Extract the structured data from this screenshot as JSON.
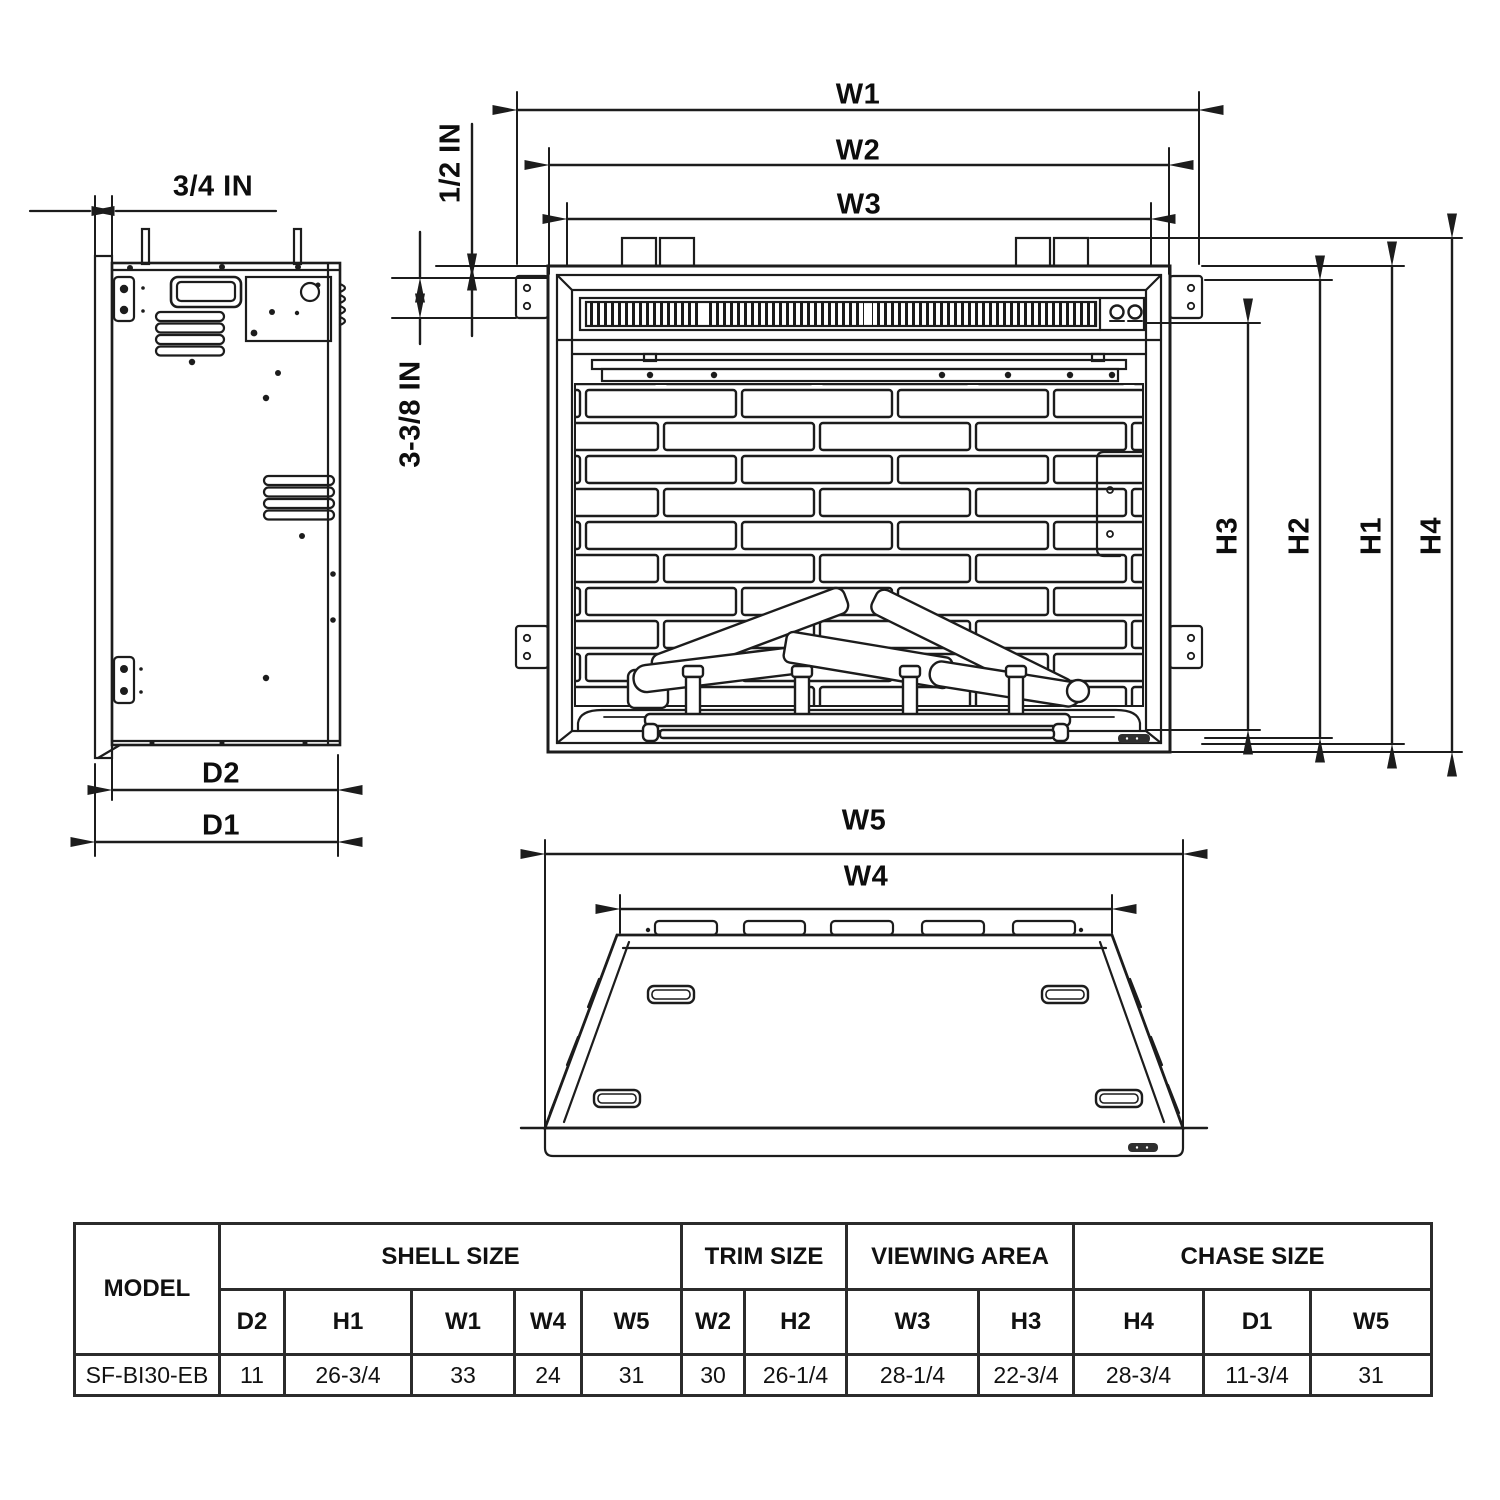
{
  "drawing": {
    "side_view": {
      "dim_flange": "3/4 IN",
      "dim_d2": "D2",
      "dim_d1": "D1"
    },
    "front_view": {
      "dim_w1": "W1",
      "dim_w2": "W2",
      "dim_w3": "W3",
      "dim_gap": "1/2 IN",
      "dim_inset": "3-3/8 IN",
      "dim_h1": "H1",
      "dim_h2": "H2",
      "dim_h3": "H3",
      "dim_h4": "H4"
    },
    "bottom_view": {
      "dim_w5": "W5",
      "dim_w4": "W4"
    }
  },
  "spec_table": {
    "model_header": "MODEL",
    "groups": [
      {
        "label": "SHELL SIZE",
        "span": 5
      },
      {
        "label": "TRIM SIZE",
        "span": 2
      },
      {
        "label": "VIEWING AREA",
        "span": 2
      },
      {
        "label": "CHASE SIZE",
        "span": 3
      }
    ],
    "sub_headers": [
      "D2",
      "H1",
      "W1",
      "W4",
      "W5",
      "W2",
      "H2",
      "W3",
      "H3",
      "H4",
      "D1",
      "W5"
    ],
    "rows": [
      {
        "model": "SF-BI30-EB",
        "values": [
          "11",
          "26-3/4",
          "33",
          "24",
          "31",
          "30",
          "26-1/4",
          "28-1/4",
          "22-3/4",
          "28-3/4",
          "11-3/4",
          "31"
        ]
      }
    ]
  }
}
